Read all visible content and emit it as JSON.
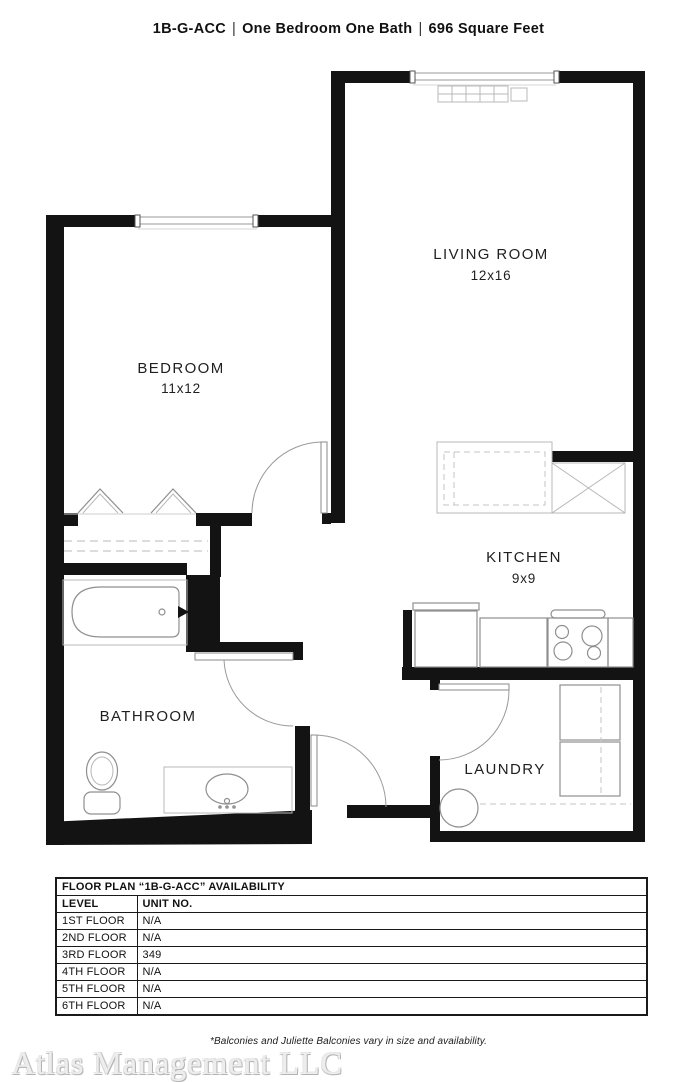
{
  "header": {
    "part1": "1B-G-ACC",
    "separator": "|",
    "part2": "One Bedroom One Bath",
    "part3": "696 Square Feet"
  },
  "rooms": {
    "living": {
      "label": "LIVING ROOM",
      "dims": "12x16"
    },
    "bedroom": {
      "label": "BEDROOM",
      "dims": "11x12"
    },
    "kitchen": {
      "label": "KITCHEN",
      "dims": "9x9"
    },
    "bathroom": {
      "label": "BATHROOM"
    },
    "laundry": {
      "label": "LAUNDRY"
    }
  },
  "availability": {
    "title": "FLOOR PLAN “1B-G-ACC” AVAILABILITY",
    "columns": {
      "level": "LEVEL",
      "unit": "UNIT NO."
    },
    "rows": [
      {
        "level": "1ST FLOOR",
        "unit": "N/A"
      },
      {
        "level": "2ND FLOOR",
        "unit": "N/A"
      },
      {
        "level": "3RD FLOOR",
        "unit": "349"
      },
      {
        "level": "4TH FLOOR",
        "unit": "N/A"
      },
      {
        "level": "5TH FLOOR",
        "unit": "N/A"
      },
      {
        "level": "6TH FLOOR",
        "unit": "N/A"
      }
    ]
  },
  "footnote": "*Balconies and Juliette Balconies vary in size and availability.",
  "watermark": "Atlas Management LLC",
  "colors": {
    "wall": "#131313",
    "fixture": "#8f8f8f",
    "text": "#1f1f1f"
  }
}
